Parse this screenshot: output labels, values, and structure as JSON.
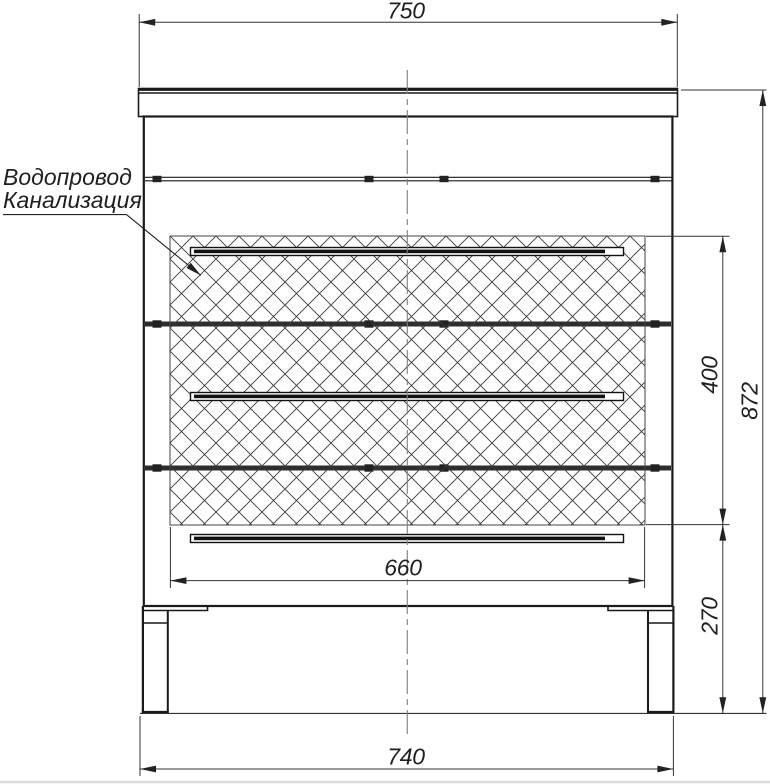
{
  "drawing": {
    "title_hint": "cabinet front elevation drawing",
    "dimensions": {
      "top_width": "750",
      "overall_height": "872",
      "hatch_zone_height": "400",
      "base_height": "270",
      "hatch_zone_width": "660",
      "body_width": "740"
    },
    "callout": {
      "line1": "Водопровод",
      "line2": "Канализация"
    },
    "colors": {
      "line": "#1a1a1a",
      "dim_line": "#333333",
      "centerline": "#808080",
      "divider_band": "#2e2e2e",
      "hatch_line": "#3a3a3a"
    }
  }
}
